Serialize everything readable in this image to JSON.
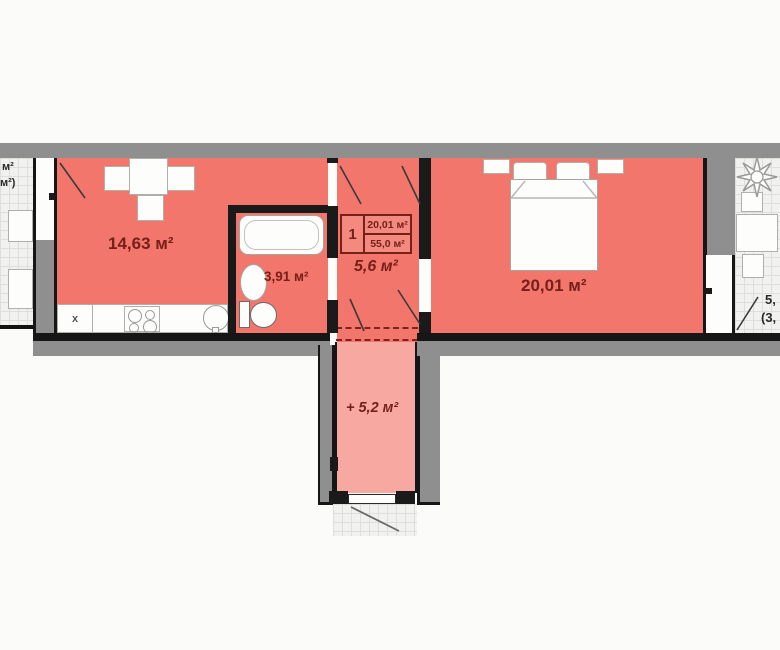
{
  "legend": {
    "number": "1",
    "room_area": "20,01 м²",
    "total_area": "55,0 м²"
  },
  "rooms": {
    "kitchen_living": {
      "label": "14,63 м²"
    },
    "bathroom": {
      "label": "3,91 м²"
    },
    "hallway": {
      "label": "5,6 м²"
    },
    "bedroom": {
      "label": "20,01 м²"
    },
    "entrance": {
      "label": "+ 5,2 м²"
    }
  },
  "balconies": {
    "left": {
      "line1": "м²",
      "line2": "м²)"
    },
    "right": {
      "line1": "5,",
      "line2": "(3,"
    }
  },
  "kitchen": {
    "fridge_marker": "x"
  },
  "colors": {
    "room_fill": "#f2766b",
    "entrance_fill": "#f7a9a1",
    "wall_gray": "#8f8f8f",
    "wall_dark": "#1a1a1a",
    "label_red": "#752019",
    "tile_bg": "#f1f1ef",
    "balcony_text": "#2a2a2a"
  }
}
